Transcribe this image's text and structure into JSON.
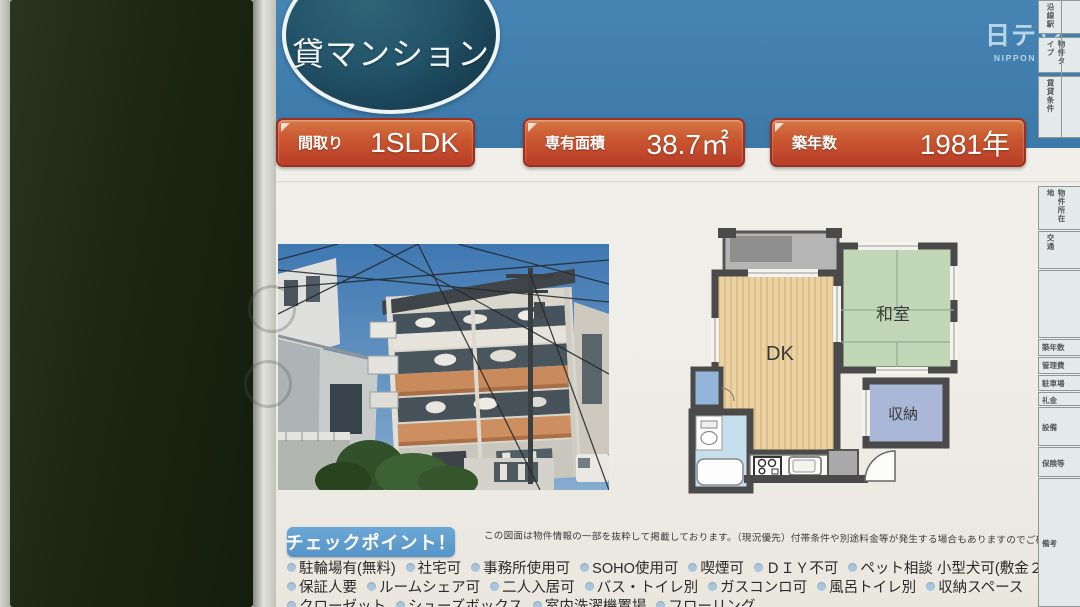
{
  "branding": {
    "logo": "日テレ",
    "logo_sub": "NIPPON TV"
  },
  "header": {
    "title": "貸マンション"
  },
  "badges": [
    {
      "label": "間取り",
      "value": "1SLDK"
    },
    {
      "label": "専有面積",
      "value": "38.7㎡"
    },
    {
      "label": "築年数",
      "value": "1981年"
    }
  ],
  "floorplan": {
    "dk": "DK",
    "japanese_room": "和室",
    "storage": "収納"
  },
  "checkpoints": {
    "heading": "チェックポイント！",
    "note": "この図面は物件情報の一部を抜粋して掲載しております。（現況優先）付帯条件や別途料金等が発生する場合もありますのでご確認ください。",
    "row1": [
      "駐輪場有(無料)",
      "社宅可",
      "事務所使用可",
      "SOHO使用可",
      "喫煙可",
      "ＤＩＹ不可",
      "ペット相談 小型犬可(敷金２か月ＵＰ)"
    ],
    "row2": [
      "保証人要",
      "ルームシェア可",
      "二人入居可",
      "バス・トイレ別",
      "ガスコンロ可",
      "風呂トイレ別",
      "収納スペース"
    ],
    "row3": [
      "クローゼット",
      "シューズボックス",
      "室内洗濯機置場",
      "フローリング"
    ]
  },
  "side_table": {
    "top": [
      "沿線駅",
      "物件タイプ",
      "賃貸条件"
    ],
    "bottom": [
      "物件所在地",
      "交通",
      "",
      "築年数",
      "管理費",
      "駐車場",
      "礼金",
      "設備",
      "保険等",
      "備考"
    ]
  },
  "colors": {
    "header_blue": "#4080b1",
    "badge_red": "#c24a31",
    "title_oval_teal": "#1f4a5c",
    "checkpoint_blue": "#5c9ccd",
    "plan_dk_floor": "#ead2a2",
    "plan_tatami_green": "#c1d7b8",
    "plan_storage_blue": "#abb7d7",
    "plan_bath_blue": "#c6dfec",
    "plan_wall_gray": "#4a4a4a"
  }
}
